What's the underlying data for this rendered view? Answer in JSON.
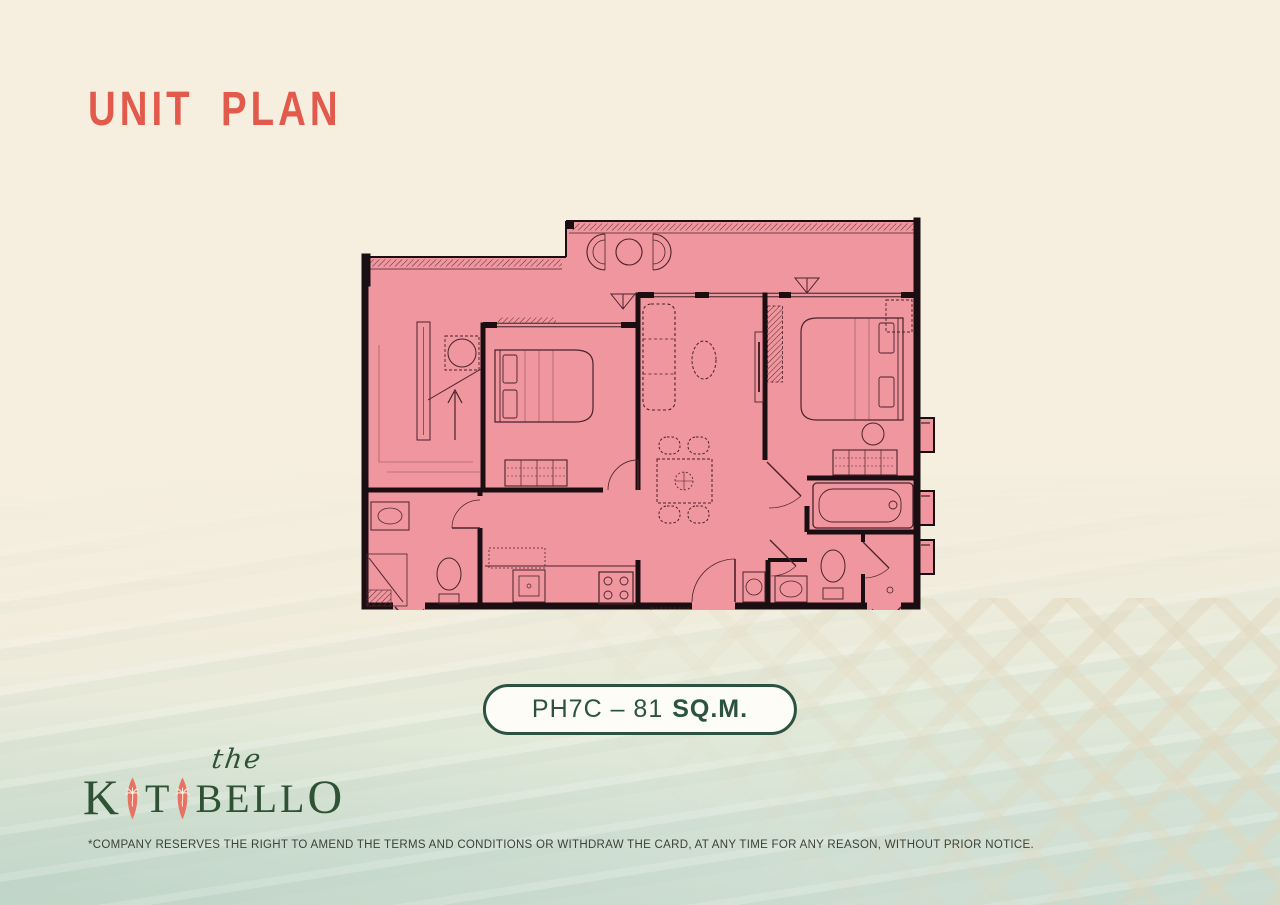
{
  "page": {
    "title": "UNIT PLAN"
  },
  "colors": {
    "background_cream": "#f6efdf",
    "title_coral": "#e25a4b",
    "plan_fill_pink": "#f0969f",
    "plan_wall_black": "#1a0e12",
    "badge_green": "#2c5240",
    "logo_green": "#2e5233",
    "logo_surfboard_coral": "#e87364",
    "water_green": "#cbdcd0"
  },
  "unit_badge": {
    "label_regular": "PH7C – 81",
    "label_bold": "SQ.M.",
    "full_text": "PH7C – 81 SQ.M."
  },
  "floor_plan": {
    "fill_color": "#f0969f",
    "wall_color": "#1a0e12",
    "features": [
      "balcony-lounge",
      "foyer-stair",
      "bedroom-left",
      "living-dining",
      "bedroom-right",
      "bathtub-room",
      "bathroom-left",
      "bathroom-right",
      "kitchen",
      "ac-ledges"
    ]
  },
  "logo": {
    "the": "the",
    "wordmark_letters": [
      "K",
      "A",
      "T",
      "A",
      "B",
      "E",
      "L",
      "L",
      "O"
    ]
  },
  "disclaimer": "*COMPANY RESERVES THE RIGHT TO AMEND THE TERMS AND CONDITIONS OR WITHDRAW THE CARD, AT ANY TIME FOR ANY REASON, WITHOUT PRIOR NOTICE."
}
